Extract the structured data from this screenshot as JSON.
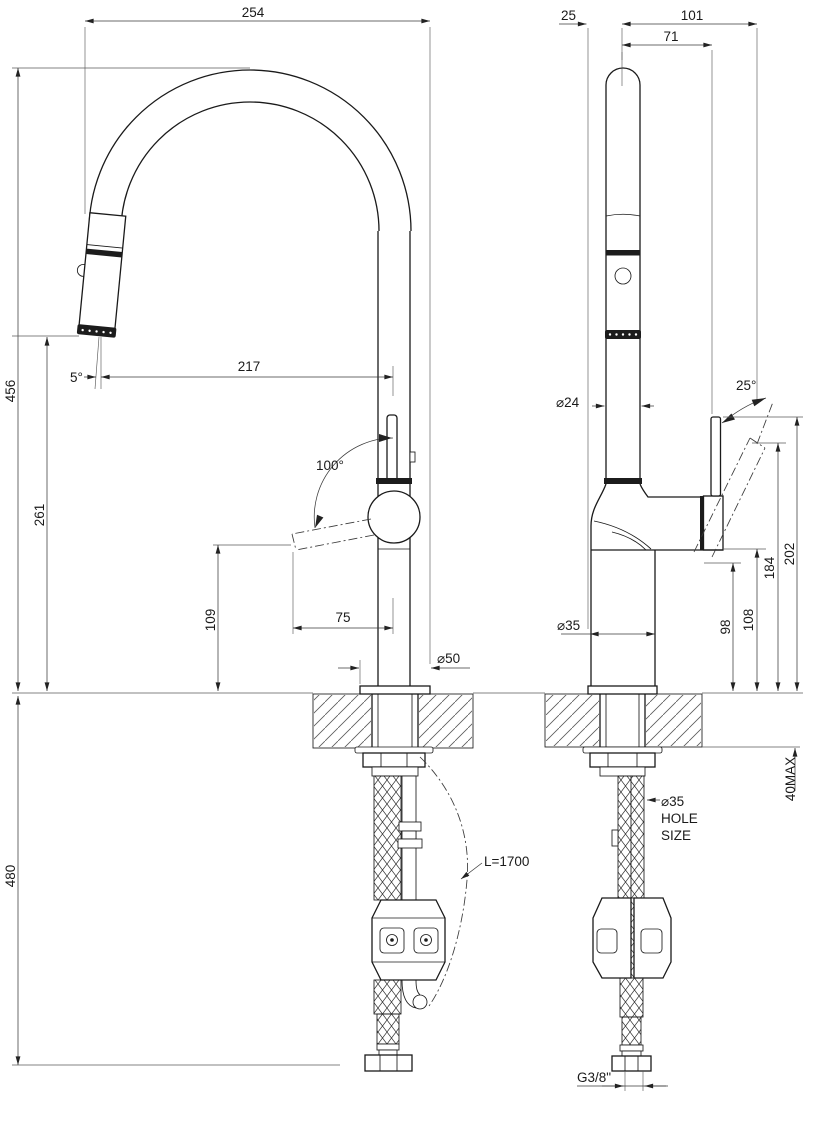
{
  "front_view": {
    "dim_254": "254",
    "dim_456": "456",
    "dim_261": "261",
    "dim_480": "480",
    "dim_217": "217",
    "angle_5": "5°",
    "angle_100": "100°",
    "dim_109": "109",
    "dim_75": "75",
    "dim_d50": "⌀50",
    "hose_length": "L=1700"
  },
  "side_view": {
    "dim_25": "25",
    "dim_101": "101",
    "dim_71": "71",
    "dim_d24": "⌀24",
    "angle_25": "25°",
    "dim_202": "202",
    "dim_184": "184",
    "dim_108": "108",
    "dim_98": "98",
    "dim_d35": "⌀35",
    "dim_40max": "40MAX",
    "hole_note_d35": "⌀35",
    "hole_note_hole": "HOLE",
    "hole_note_size": "SIZE",
    "thread": "G3/8\""
  }
}
